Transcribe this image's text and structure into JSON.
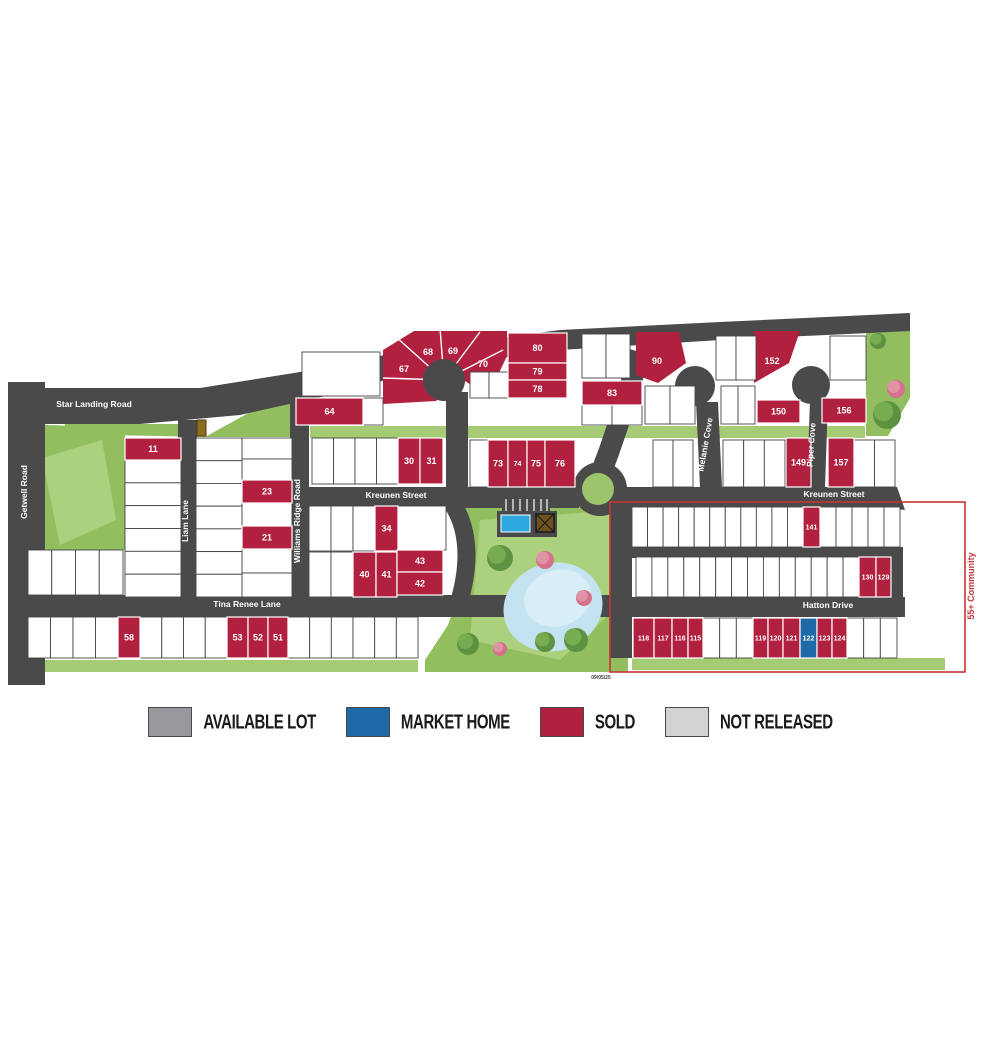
{
  "legend": {
    "items": [
      {
        "label": "AVAILABLE LOT",
        "status": "available"
      },
      {
        "label": "MARKET HOME",
        "status": "market"
      },
      {
        "label": "SOLD",
        "status": "sold"
      },
      {
        "label": "NOT RELEASED",
        "status": "not_released"
      }
    ]
  },
  "colors": {
    "available": "#98989E",
    "market": "#1E6AA9",
    "sold": "#B2203F",
    "not_released": "#D3D3D5",
    "road": "#4A4A4A",
    "park": "#92BE60",
    "park_light": "#ABD07E",
    "pond": "#C4E3F0",
    "pool": "#2FA8DF",
    "outline_55": "#C53434",
    "lot_fill": "#FFFFFF",
    "lot_stroke": "#454545"
  },
  "map": {
    "community_label": "55+ Community",
    "date_stamp": "09/05/25",
    "streets": [
      {
        "id": "star_landing",
        "label": "Star Landing Road"
      },
      {
        "id": "getwell",
        "label": "Getwell Road"
      },
      {
        "id": "liam",
        "label": "Liam Lane"
      },
      {
        "id": "williams",
        "label": "Williams Ridge Road"
      },
      {
        "id": "kreunen_w",
        "label": "Kreunen Street"
      },
      {
        "id": "kreunen_e",
        "label": "Kreunen Street"
      },
      {
        "id": "tina",
        "label": "Tina Renee Lane"
      },
      {
        "id": "melanie",
        "label": "Melanie Cove"
      },
      {
        "id": "piper",
        "label": "Piper Cove"
      },
      {
        "id": "hatton",
        "label": "Hatton Drive"
      }
    ],
    "lots": [
      {
        "num": "11",
        "status": "sold",
        "x": 125,
        "y": 438,
        "w": 56,
        "h": 22
      },
      {
        "num": "23",
        "status": "sold",
        "x": 242,
        "y": 480,
        "w": 50,
        "h": 23
      },
      {
        "num": "21",
        "status": "sold",
        "x": 242,
        "y": 526,
        "w": 50,
        "h": 23
      },
      {
        "num": "30",
        "status": "sold",
        "x": 398,
        "y": 438,
        "w": 22,
        "h": 46
      },
      {
        "num": "31",
        "status": "sold",
        "x": 420,
        "y": 438,
        "w": 23,
        "h": 46
      },
      {
        "num": "34",
        "status": "sold",
        "x": 375,
        "y": 506,
        "w": 23,
        "h": 45
      },
      {
        "num": "40",
        "status": "sold",
        "x": 353,
        "y": 552,
        "w": 23,
        "h": 45
      },
      {
        "num": "41",
        "status": "sold",
        "x": 376,
        "y": 552,
        "w": 21,
        "h": 45
      },
      {
        "num": "43",
        "status": "sold",
        "x": 397,
        "y": 550,
        "w": 46,
        "h": 22
      },
      {
        "num": "42",
        "status": "sold",
        "x": 397,
        "y": 572,
        "w": 46,
        "h": 23
      },
      {
        "num": "58",
        "status": "sold",
        "x": 118,
        "y": 617,
        "w": 22,
        "h": 41
      },
      {
        "num": "53",
        "status": "sold",
        "x": 227,
        "y": 617,
        "w": 21,
        "h": 41
      },
      {
        "num": "52",
        "status": "sold",
        "x": 248,
        "y": 617,
        "w": 20,
        "h": 41
      },
      {
        "num": "51",
        "status": "sold",
        "x": 268,
        "y": 617,
        "w": 20,
        "h": 41
      },
      {
        "num": "64",
        "status": "sold",
        "x": 296,
        "y": 398,
        "w": 67,
        "h": 27
      },
      {
        "num": "67",
        "status": "sold",
        "shape": "static",
        "lx": 404,
        "ly": 369
      },
      {
        "num": "68",
        "status": "sold",
        "shape": "static",
        "lx": 428,
        "ly": 352
      },
      {
        "num": "69",
        "status": "sold",
        "shape": "static",
        "lx": 453,
        "ly": 351
      },
      {
        "num": "70",
        "status": "sold",
        "shape": "static",
        "lx": 483,
        "ly": 364
      },
      {
        "num": "73",
        "status": "sold",
        "x": 488,
        "y": 440,
        "w": 20,
        "h": 47
      },
      {
        "num": "74",
        "status": "sold",
        "x": 508,
        "y": 440,
        "w": 19,
        "h": 47
      },
      {
        "num": "75",
        "status": "sold",
        "x": 527,
        "y": 440,
        "w": 18,
        "h": 47,
        "fs": 9
      },
      {
        "num": "76",
        "status": "sold",
        "x": 545,
        "y": 440,
        "w": 30,
        "h": 47
      },
      {
        "num": "80",
        "status": "sold",
        "x": 508,
        "y": 333,
        "w": 59,
        "h": 30
      },
      {
        "num": "79",
        "status": "sold",
        "x": 508,
        "y": 363,
        "w": 59,
        "h": 17
      },
      {
        "num": "78",
        "status": "sold",
        "x": 508,
        "y": 380,
        "w": 59,
        "h": 18
      },
      {
        "num": "83",
        "status": "sold",
        "x": 582,
        "y": 381,
        "w": 60,
        "h": 24
      },
      {
        "num": "90",
        "status": "sold",
        "shape": "static",
        "lx": 657,
        "ly": 361
      },
      {
        "num": "152",
        "status": "sold",
        "shape": "static",
        "lx": 772,
        "ly": 361
      },
      {
        "num": "150",
        "status": "sold",
        "x": 757,
        "y": 400,
        "w": 43,
        "h": 23
      },
      {
        "num": "156",
        "status": "sold",
        "x": 822,
        "y": 398,
        "w": 44,
        "h": 25
      },
      {
        "num": "149",
        "status": "sold",
        "x": 786,
        "y": 438,
        "w": 25,
        "h": 49
      },
      {
        "num": "157",
        "status": "sold",
        "x": 828,
        "y": 438,
        "w": 26,
        "h": 49
      },
      {
        "num": "141",
        "status": "sold",
        "x": 803,
        "y": 507,
        "w": 17,
        "h": 40
      },
      {
        "num": "130",
        "status": "sold",
        "x": 859,
        "y": 557,
        "w": 17,
        "h": 40
      },
      {
        "num": "129",
        "status": "sold",
        "x": 876,
        "y": 557,
        "w": 15,
        "h": 40
      },
      {
        "num": "118",
        "status": "sold",
        "x": 633,
        "y": 618,
        "w": 21,
        "h": 40,
        "fs": 7
      },
      {
        "num": "117",
        "status": "sold",
        "x": 654,
        "y": 618,
        "w": 18,
        "h": 40
      },
      {
        "num": "116",
        "status": "sold",
        "x": 672,
        "y": 618,
        "w": 16,
        "h": 40
      },
      {
        "num": "115",
        "status": "sold",
        "x": 688,
        "y": 618,
        "w": 15,
        "h": 40
      },
      {
        "num": "119",
        "status": "sold",
        "x": 753,
        "y": 618,
        "w": 15,
        "h": 40
      },
      {
        "num": "120",
        "status": "sold",
        "x": 768,
        "y": 618,
        "w": 15,
        "h": 40
      },
      {
        "num": "121",
        "status": "sold",
        "x": 783,
        "y": 618,
        "w": 17,
        "h": 40
      },
      {
        "num": "122",
        "status": "market",
        "x": 800,
        "y": 618,
        "w": 17,
        "h": 40
      },
      {
        "num": "123",
        "status": "sold",
        "x": 817,
        "y": 618,
        "w": 15,
        "h": 40
      },
      {
        "num": "124",
        "status": "sold",
        "x": 832,
        "y": 618,
        "w": 15,
        "h": 40
      }
    ]
  }
}
